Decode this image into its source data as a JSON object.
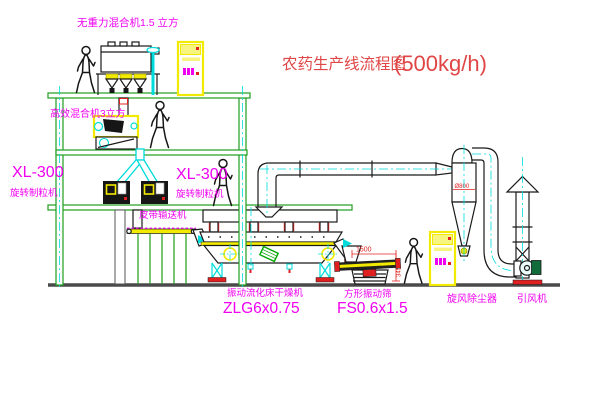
{
  "palette": {
    "line": "#1a1a1a",
    "machine": "#f2ea00",
    "frame": "#1f9e1f",
    "center": "#00dcdc",
    "label": "#f000f0",
    "title": "#e04646",
    "red": "#e02020",
    "ground": "#4a4a4a",
    "green-detail": "#00a800"
  },
  "title": {
    "name": "农药生产线流程图",
    "capacity": "(500kg/h)"
  },
  "equipment": {
    "mixer_top": {
      "label": "无重力混合机1.5 立方"
    },
    "mixer_mid": {
      "label": "高效混合机3立方"
    },
    "granulator_left": {
      "model": "XL-300",
      "label": "旋转制粒机"
    },
    "granulator_right": {
      "model": "XL-300",
      "label": "旋转制粒机"
    },
    "belt_conveyor": {
      "label": "皮带输送机"
    },
    "fluid_bed_dryer": {
      "label": "振动流化床干燥机",
      "model": "ZLG6x0.75"
    },
    "square_sieve": {
      "label": "方形振动筛",
      "model": "FS0.6x1.5",
      "dim_length": "1500",
      "dim_height": "345"
    },
    "cyclone": {
      "label": "旋风除尘器",
      "dim": "Ø800"
    },
    "fan": {
      "label": "引风机"
    }
  }
}
